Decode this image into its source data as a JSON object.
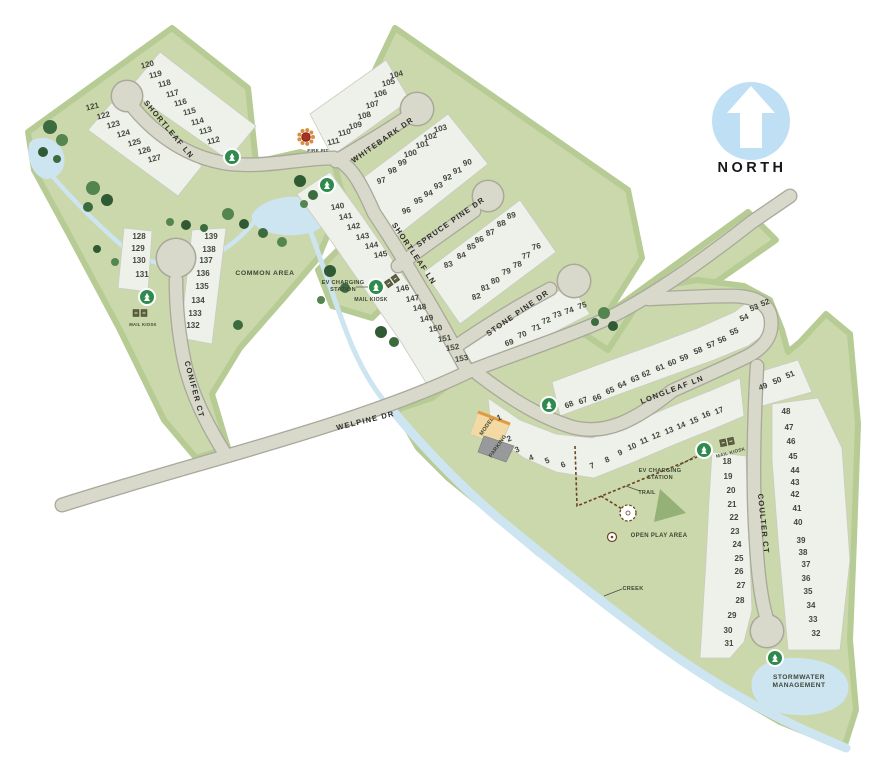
{
  "north": {
    "label": "NORTH"
  },
  "streets": [
    {
      "id": "shortleaf-upper",
      "name": "SHORTLEAF LN",
      "x": 167,
      "y": 131,
      "rot": 50
    },
    {
      "id": "shortleaf-lower",
      "name": "SHORTLEAF LN",
      "x": 412,
      "y": 255,
      "rot": 56
    },
    {
      "id": "whitebark-dr",
      "name": "WHITEBARK DR",
      "x": 384,
      "y": 142,
      "rot": -35
    },
    {
      "id": "spruce-pine-dr",
      "name": "SPRUCE PINE DR",
      "x": 452,
      "y": 224,
      "rot": -35
    },
    {
      "id": "stone-pine-dr",
      "name": "STONE PINE DR",
      "x": 519,
      "y": 315,
      "rot": -35
    },
    {
      "id": "welpine-dr",
      "name": "WELPINE DR",
      "x": 366,
      "y": 423,
      "rot": -14
    },
    {
      "id": "conifer-ct",
      "name": "CONIFER CT",
      "x": 192,
      "y": 390,
      "rot": 75
    },
    {
      "id": "longleaf-ln",
      "name": "LONGLEAF LN",
      "x": 673,
      "y": 392,
      "rot": -21
    },
    {
      "id": "coulter-ct",
      "name": "COULTER CT",
      "x": 761,
      "y": 524,
      "rot": 84
    }
  ],
  "lots": [
    [
      120,
      148,
      67,
      -14
    ],
    [
      119,
      156,
      77,
      -14
    ],
    [
      118,
      165,
      86,
      -14
    ],
    [
      117,
      173,
      96,
      -14
    ],
    [
      116,
      181,
      105,
      -14
    ],
    [
      115,
      190,
      114,
      -14
    ],
    [
      114,
      198,
      124,
      -14
    ],
    [
      113,
      206,
      133,
      -14
    ],
    [
      112,
      214,
      143,
      -14
    ],
    [
      121,
      93,
      109,
      -14
    ],
    [
      122,
      104,
      118,
      -14
    ],
    [
      123,
      114,
      127,
      -14
    ],
    [
      124,
      124,
      136,
      -14
    ],
    [
      125,
      135,
      145,
      -14
    ],
    [
      126,
      145,
      153,
      -14
    ],
    [
      127,
      155,
      161,
      -14
    ],
    [
      104,
      397,
      77,
      -14
    ],
    [
      105,
      389,
      85,
      -14
    ],
    [
      106,
      381,
      96,
      -14
    ],
    [
      107,
      373,
      107,
      -14
    ],
    [
      108,
      365,
      118,
      -14
    ],
    [
      109,
      356,
      128,
      -14
    ],
    [
      110,
      345,
      135,
      -14
    ],
    [
      111,
      334,
      144,
      -14
    ],
    [
      103,
      441,
      131,
      -14
    ],
    [
      102,
      431,
      139,
      -14
    ],
    [
      101,
      423,
      147,
      -14
    ],
    [
      100,
      411,
      156,
      -14
    ],
    [
      99,
      403,
      165,
      -14
    ],
    [
      98,
      393,
      173,
      -14
    ],
    [
      97,
      382,
      183,
      -14
    ],
    [
      90,
      468,
      165,
      -14
    ],
    [
      91,
      458,
      173,
      -14
    ],
    [
      92,
      448,
      180,
      -14
    ],
    [
      93,
      439,
      188,
      -14
    ],
    [
      94,
      429,
      196,
      -14
    ],
    [
      95,
      419,
      203,
      -14
    ],
    [
      96,
      407,
      213,
      -14
    ],
    [
      89,
      512,
      218,
      -14
    ],
    [
      88,
      502,
      226,
      -14
    ],
    [
      87,
      491,
      235,
      -14
    ],
    [
      86,
      480,
      242,
      -14
    ],
    [
      85,
      472,
      249,
      -14
    ],
    [
      84,
      462,
      258,
      -14
    ],
    [
      83,
      449,
      267,
      -14
    ],
    [
      76,
      537,
      249,
      -14
    ],
    [
      77,
      527,
      258,
      -14
    ],
    [
      78,
      518,
      267,
      -14
    ],
    [
      79,
      507,
      274,
      -14
    ],
    [
      80,
      496,
      283,
      -14
    ],
    [
      81,
      486,
      290,
      -14
    ],
    [
      82,
      477,
      299,
      -14
    ],
    [
      75,
      583,
      308,
      -18
    ],
    [
      74,
      570,
      313,
      -18
    ],
    [
      73,
      558,
      317,
      -18
    ],
    [
      72,
      547,
      323,
      -18
    ],
    [
      71,
      537,
      330,
      -18
    ],
    [
      70,
      523,
      337,
      -18
    ],
    [
      69,
      510,
      345,
      -18
    ],
    [
      140,
      338,
      209,
      -10
    ],
    [
      141,
      346,
      219,
      -10
    ],
    [
      142,
      354,
      229,
      -10
    ],
    [
      143,
      363,
      239,
      -10
    ],
    [
      144,
      372,
      248,
      -10
    ],
    [
      145,
      381,
      257,
      -10
    ],
    [
      146,
      403,
      291,
      -10
    ],
    [
      147,
      413,
      301,
      -10
    ],
    [
      148,
      420,
      310,
      -10
    ],
    [
      149,
      427,
      321,
      -10
    ],
    [
      150,
      436,
      331,
      -10
    ],
    [
      151,
      445,
      341,
      -10
    ],
    [
      152,
      453,
      350,
      -10
    ],
    [
      153,
      462,
      361,
      -10
    ],
    [
      128,
      139,
      239,
      0
    ],
    [
      129,
      138,
      251,
      0
    ],
    [
      130,
      139,
      263,
      0
    ],
    [
      131,
      142,
      277,
      0
    ],
    [
      139,
      211,
      239,
      0
    ],
    [
      138,
      209,
      252,
      0
    ],
    [
      137,
      206,
      263,
      0
    ],
    [
      136,
      203,
      276,
      0
    ],
    [
      135,
      202,
      289,
      0
    ],
    [
      134,
      198,
      303,
      0
    ],
    [
      133,
      195,
      316,
      0
    ],
    [
      132,
      193,
      328,
      0
    ],
    [
      52,
      766,
      305,
      -22
    ],
    [
      53,
      755,
      310,
      -22
    ],
    [
      54,
      745,
      320,
      -22
    ],
    [
      55,
      735,
      334,
      -22
    ],
    [
      56,
      723,
      342,
      -22
    ],
    [
      57,
      712,
      347,
      -22
    ],
    [
      58,
      699,
      353,
      -22
    ],
    [
      59,
      685,
      360,
      -22
    ],
    [
      60,
      673,
      365,
      -22
    ],
    [
      61,
      661,
      370,
      -22
    ],
    [
      62,
      647,
      376,
      -22
    ],
    [
      63,
      636,
      381,
      -22
    ],
    [
      64,
      623,
      387,
      -22
    ],
    [
      65,
      611,
      393,
      -22
    ],
    [
      66,
      598,
      400,
      -22
    ],
    [
      67,
      584,
      403,
      -22
    ],
    [
      68,
      570,
      407,
      -22
    ],
    [
      49,
      764,
      389,
      -22
    ],
    [
      50,
      778,
      383,
      -22
    ],
    [
      51,
      791,
      377,
      -22
    ],
    [
      1,
      500,
      420,
      -22
    ],
    [
      2,
      510,
      441,
      -22
    ],
    [
      3,
      518,
      452,
      -22
    ],
    [
      4,
      532,
      460,
      -22
    ],
    [
      5,
      548,
      463,
      -22
    ],
    [
      6,
      564,
      467,
      -22
    ],
    [
      7,
      593,
      468,
      -22
    ],
    [
      8,
      608,
      462,
      -22
    ],
    [
      9,
      621,
      455,
      -22
    ],
    [
      10,
      633,
      449,
      -22
    ],
    [
      11,
      645,
      443,
      -22
    ],
    [
      12,
      657,
      438,
      -22
    ],
    [
      13,
      670,
      433,
      -22
    ],
    [
      14,
      682,
      428,
      -22
    ],
    [
      15,
      695,
      423,
      -22
    ],
    [
      16,
      707,
      417,
      -22
    ],
    [
      17,
      720,
      413,
      -22
    ],
    [
      18,
      727,
      464,
      0
    ],
    [
      19,
      728,
      479,
      0
    ],
    [
      20,
      731,
      493,
      0
    ],
    [
      21,
      732,
      507,
      0
    ],
    [
      22,
      734,
      520,
      0
    ],
    [
      23,
      735,
      534,
      0
    ],
    [
      24,
      737,
      547,
      0
    ],
    [
      25,
      739,
      561,
      0
    ],
    [
      26,
      739,
      574,
      0
    ],
    [
      27,
      741,
      588,
      0
    ],
    [
      28,
      740,
      603,
      0
    ],
    [
      29,
      732,
      618,
      0
    ],
    [
      30,
      728,
      633,
      0
    ],
    [
      31,
      729,
      646,
      0
    ],
    [
      48,
      786,
      414,
      0
    ],
    [
      47,
      789,
      430,
      0
    ],
    [
      46,
      791,
      444,
      0
    ],
    [
      45,
      793,
      459,
      0
    ],
    [
      44,
      795,
      473,
      0
    ],
    [
      43,
      795,
      485,
      0
    ],
    [
      42,
      795,
      497,
      0
    ],
    [
      41,
      797,
      511,
      0
    ],
    [
      40,
      798,
      525,
      0
    ],
    [
      39,
      801,
      543,
      0
    ],
    [
      38,
      803,
      555,
      0
    ],
    [
      37,
      806,
      567,
      0
    ],
    [
      36,
      806,
      581,
      0
    ],
    [
      35,
      808,
      594,
      0
    ],
    [
      34,
      811,
      608,
      0
    ],
    [
      33,
      813,
      622,
      0
    ],
    [
      32,
      816,
      636,
      0
    ]
  ],
  "amenity_labels": [
    {
      "id": "common-area",
      "text": "COMMON AREA",
      "x": 265,
      "y": 275,
      "size": 6.8,
      "ls": 0.6
    },
    {
      "id": "ev-charging-left",
      "lines": [
        "EV CHARGING",
        "STATION"
      ],
      "x": 343,
      "y": 284,
      "size": 5.6
    },
    {
      "id": "mail-kiosk-left",
      "text": "MAIL KIOSK",
      "x": 371,
      "y": 301,
      "size": 5.2
    },
    {
      "id": "ev-charging-right",
      "lines": [
        "EV CHARGING",
        "STATION"
      ],
      "x": 660,
      "y": 472,
      "size": 5.6
    },
    {
      "id": "mail-kiosk-right",
      "text": "MAIL KIOSK",
      "x": 731,
      "y": 454,
      "size": 4.6,
      "rot": -15
    },
    {
      "id": "mail-kiosk-conifer",
      "text": "MAIL KIOSK",
      "x": 143,
      "y": 326,
      "size": 4.2
    },
    {
      "id": "fire-pit",
      "text": "FIRE PIT",
      "x": 318,
      "y": 152,
      "size": 4.6
    },
    {
      "id": "trail",
      "text": "TRAIL",
      "x": 647,
      "y": 494,
      "size": 5.4
    },
    {
      "id": "open-play-area",
      "text": "OPEN PLAY AREA",
      "x": 659,
      "y": 537,
      "size": 6
    },
    {
      "id": "creek",
      "text": "CREEK",
      "x": 633,
      "y": 590,
      "size": 5.6
    },
    {
      "id": "stormwater-management",
      "lines": [
        "STORMWATER",
        "MANAGEMENT"
      ],
      "x": 799,
      "y": 679,
      "size": 6.6,
      "color": "#8fb3c9",
      "ls": 0.5
    },
    {
      "id": "model",
      "text": "MODEL",
      "x": 488,
      "y": 427,
      "size": 5.4,
      "rot": -55,
      "color": "#6b4513"
    },
    {
      "id": "parking",
      "text": "PARKING",
      "x": 499,
      "y": 447,
      "size": 5.4,
      "rot": -55,
      "color": "#26282a"
    }
  ],
  "amenity_markers": [
    [
      232,
      157
    ],
    [
      327,
      185
    ],
    [
      147,
      297
    ],
    [
      376,
      287
    ],
    [
      549,
      405
    ],
    [
      704,
      450
    ],
    [
      775,
      658
    ]
  ],
  "mail_kiosk_icons": [
    [
      392,
      281,
      -35
    ],
    [
      727,
      442,
      -12
    ],
    [
      140,
      313,
      0
    ]
  ],
  "fire_pit_icon": {
    "x": 306,
    "y": 137
  },
  "trees": [
    [
      50,
      127,
      7
    ],
    [
      62,
      140,
      6
    ],
    [
      43,
      152,
      5
    ],
    [
      57,
      159,
      4
    ],
    [
      93,
      188,
      7
    ],
    [
      107,
      200,
      6
    ],
    [
      88,
      207,
      5
    ],
    [
      170,
      222,
      4
    ],
    [
      186,
      225,
      5
    ],
    [
      204,
      228,
      4
    ],
    [
      228,
      214,
      6
    ],
    [
      244,
      224,
      5
    ],
    [
      263,
      233,
      5
    ],
    [
      282,
      242,
      5
    ],
    [
      300,
      181,
      6
    ],
    [
      313,
      195,
      5
    ],
    [
      304,
      204,
      4
    ],
    [
      330,
      271,
      6
    ],
    [
      345,
      288,
      5
    ],
    [
      321,
      300,
      4
    ],
    [
      381,
      332,
      6
    ],
    [
      394,
      342,
      5
    ],
    [
      115,
      262,
      4
    ],
    [
      97,
      249,
      4
    ],
    [
      238,
      325,
      5
    ],
    [
      604,
      313,
      6
    ],
    [
      613,
      326,
      5
    ],
    [
      595,
      322,
      4
    ]
  ],
  "colors": {
    "site_green": "#cbd8ab",
    "boundary_band": "#b7cb94",
    "road": "#d9d9cb",
    "road_edge": "#a9a99b",
    "lot_band": "#eef0ea",
    "water": "#cde4f1",
    "marker_green": "#2f8a4e",
    "north_circle": "#bfe0f4",
    "model_lot": "#f3d9a2",
    "model_edge": "#e39a3c",
    "parking_lot": "#97999b",
    "trail_brown": "#6b4423"
  }
}
